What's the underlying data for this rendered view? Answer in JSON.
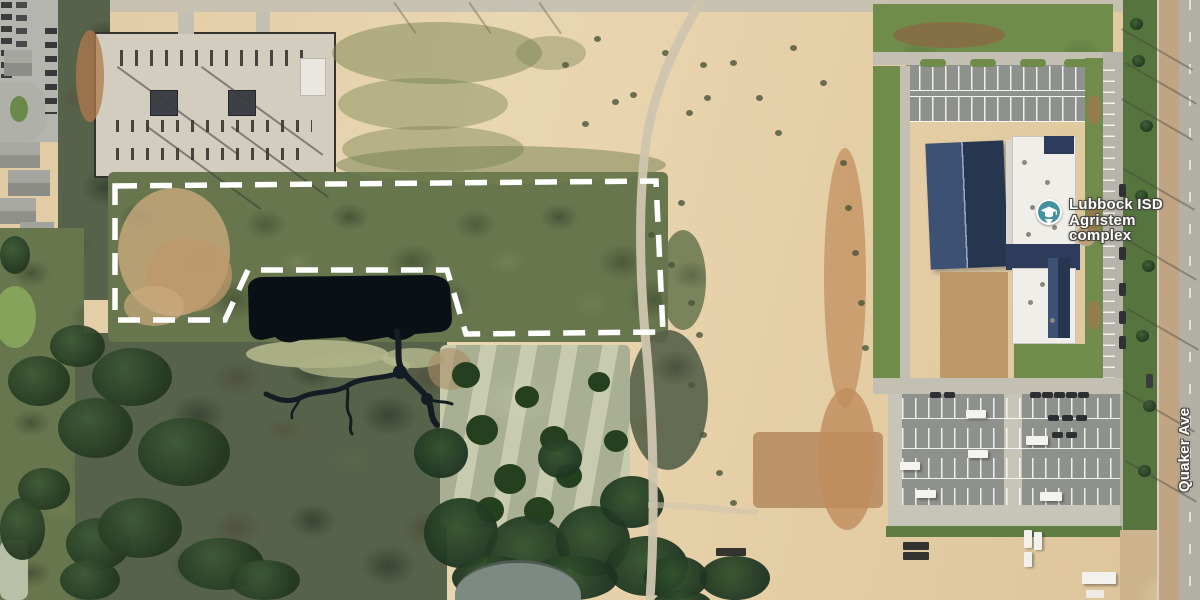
{
  "map": {
    "view": "satellite",
    "poi_label": {
      "line1": "Lubbock ISD",
      "line2": "Agristem complex",
      "icon": "graduation-cap-icon",
      "icon_color": "#44929f"
    },
    "street_label": {
      "name": "Quaker Ave"
    },
    "boundary": {
      "description": "dashed parcel outline",
      "points": "115,186 656,181 663,332 466,334 447,270 248,270 225,320 115,320",
      "color": "#ffffff",
      "stroke_width": 5.5,
      "dash": "22 13"
    },
    "colors": {
      "label_text": "#ffffff",
      "label_outline": "#444240",
      "pond_water": "#0a1016",
      "dirt_field": "#e4cda4",
      "scrub_green": "#68764e",
      "road_gray": "#b3b0a5"
    }
  }
}
